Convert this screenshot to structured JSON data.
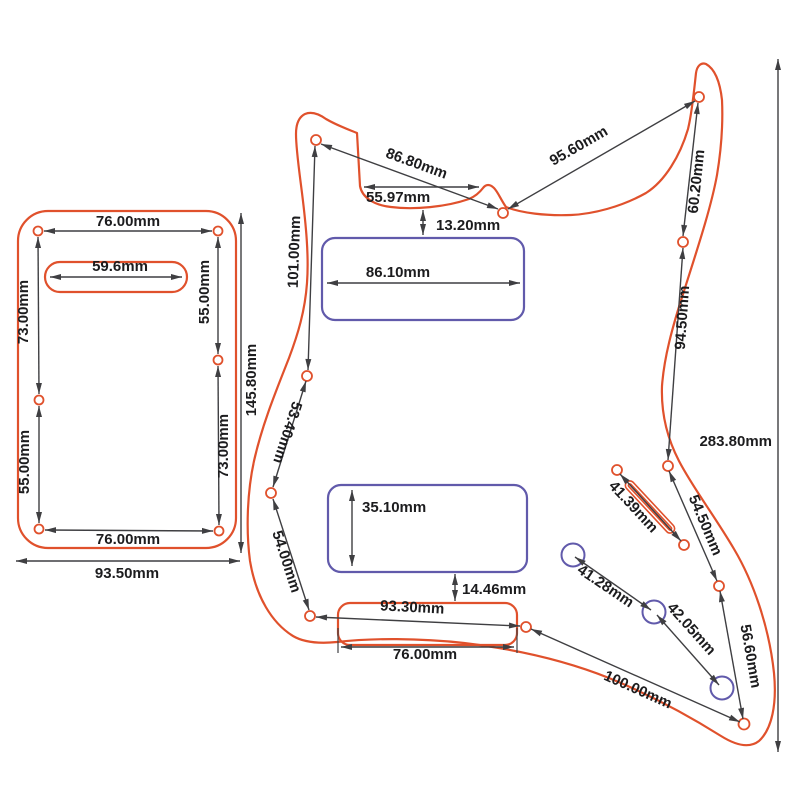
{
  "title": "Pickguard dimension drawing",
  "units": "mm",
  "colors": {
    "outline": "#e0512c",
    "cutout": "#615aab",
    "dim": "#3f3f42",
    "ink": "#1c1c1e",
    "background": "#ffffff"
  },
  "back_plate": {
    "dims": {
      "top_holes_width": "76.00mm",
      "slot_width": "59.6mm",
      "left_upper": "73.00mm",
      "left_lower": "55.00mm",
      "right_upper": "55.00mm",
      "right_lower": "73.00mm",
      "bottom_holes_width": "76.00mm",
      "overall_width": "93.50mm",
      "overall_height": "145.80mm"
    }
  },
  "pickguard": {
    "dims": {
      "horn_to_neck": "86.80mm",
      "neck_pocket_width": "55.97mm",
      "pocket_to_pickup": "13.20mm",
      "upper_left_edge": "101.00mm",
      "neck_to_horn": "95.60mm",
      "horn_drop": "60.20mm",
      "right_mid": "94.50mm",
      "overall_height": "283.80mm",
      "neck_pickup_width": "86.10mm",
      "left_mid": "53.40mm",
      "bridge_pickup_height": "35.10mm",
      "left_lower": "54.00mm",
      "pickup_to_bridge": "14.46mm",
      "bridge_holes": "93.30mm",
      "bridge_cutout_width": "76.00mm",
      "switch_slot": "41.39mm",
      "right_lower": "54.50mm",
      "knobs_1_2": "41.28mm",
      "knobs_2_3": "42.05mm",
      "right_bottom": "56.60mm",
      "bridge_to_corner": "100.00mm"
    }
  }
}
